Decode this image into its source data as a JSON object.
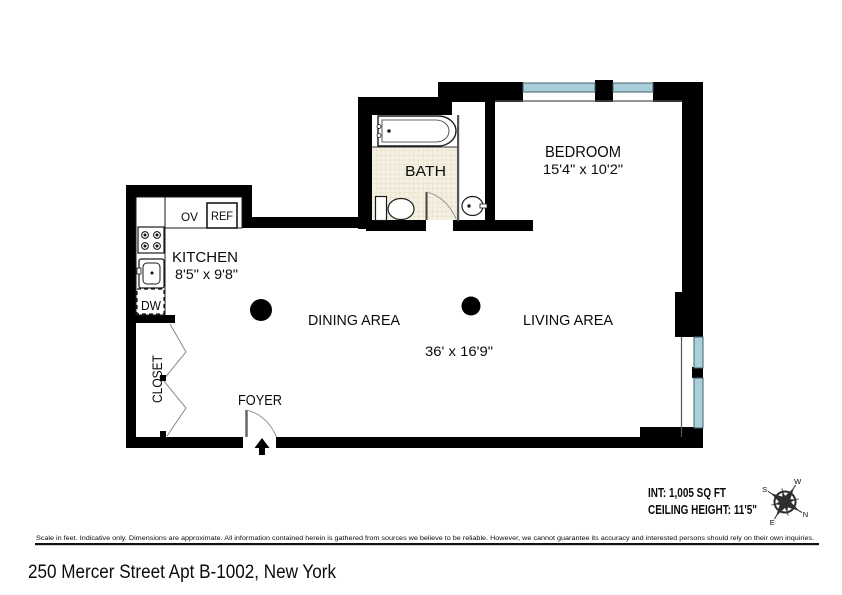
{
  "address": "250 Mercer Street Apt B-1002, New York",
  "plan": {
    "rooms": {
      "bedroom": {
        "label": "BEDROOM",
        "dims": "15'4\" x 10'2\""
      },
      "bath": {
        "label": "BATH"
      },
      "kitchen": {
        "label": "KITCHEN",
        "dims": "8'5\" x 9'8\""
      },
      "dining": {
        "label": "DINING AREA"
      },
      "living": {
        "label": "LIVING AREA"
      },
      "living_dining_dims": "36' x 16'9\"",
      "closet": {
        "label": "CLOSET"
      },
      "foyer": {
        "label": "FOYER"
      }
    },
    "appliances": {
      "oven": "OV",
      "fridge": "REF",
      "dishwasher": "DW"
    },
    "colors": {
      "wall": "#000000",
      "window": "#a9cfda",
      "tile": "#f5f0e1"
    }
  },
  "info": {
    "interior_area": "INT: 1,005 SQ FT",
    "ceiling_height": "CEILING HEIGHT: 11'5\""
  },
  "compass": {
    "north": "N",
    "east": "E",
    "south": "S",
    "west": "W"
  },
  "disclaimer": "Scale in feet. Indicative only. Dimensions are approximate. All information contained herein is gathered from sources we believe to be reliable. However, we cannot guarantee its accuracy and interested persons should rely on their own inquiries."
}
